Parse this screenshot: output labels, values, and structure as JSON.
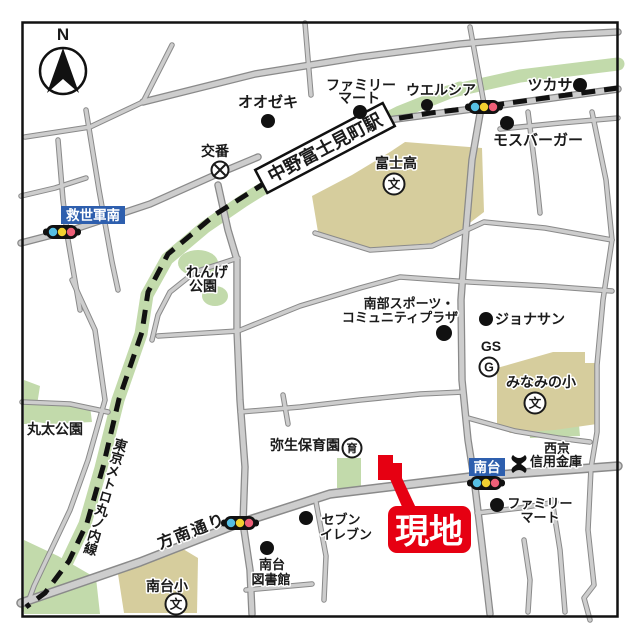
{
  "compass": {
    "north": "N"
  },
  "station": {
    "name": "中野富士見町駅"
  },
  "railway": {
    "name": "東京メトロ丸ノ内線"
  },
  "streets": {
    "honan_dori": "方南通り"
  },
  "site": {
    "label": "現地"
  },
  "signals": {
    "kyuseigun_minami": "救世軍南",
    "minamidai": "南台"
  },
  "pois": {
    "oozeki": "オオゼキ",
    "familymart_north": {
      "line1": "ファミリー",
      "line2": "マート"
    },
    "welcia": "ウエルシア",
    "tsukasa": "ツカサ",
    "mos_burger": "モスバーガー",
    "koban": "交番",
    "fuji_high": "富士高",
    "renge_park": {
      "line1": "れんげ",
      "line2": "公園"
    },
    "nanbu_plaza": {
      "line1": "南部スポーツ・",
      "line2": "コミュニティプラザ"
    },
    "jonathan": "ジョナサン",
    "gas_station": "GS",
    "minamino_elem": "みなみの小",
    "maruta_park": "丸太公園",
    "yayoi_nursery": "弥生保育園",
    "seikyo_shinkin": {
      "line1": "西京",
      "line2": "信用金庫"
    },
    "familymart_south": {
      "line1": "ファミリー",
      "line2": "マート"
    },
    "seven_eleven": {
      "line1": "セブン",
      "line2": "イレブン"
    },
    "minamidai_library": {
      "line1": "南台",
      "line2": "図書館"
    },
    "minamidai_elem": "南台小"
  },
  "symbols": {
    "school": "文",
    "nursery": "育",
    "gas": "G"
  },
  "colors": {
    "site_red": "#e60012",
    "signal_label_blue": "#2e5fae",
    "park_green": "#c2daab",
    "school_beige": "#d6cd9d",
    "road_gray": "#cdcdcd",
    "railway_black": "#111111"
  }
}
